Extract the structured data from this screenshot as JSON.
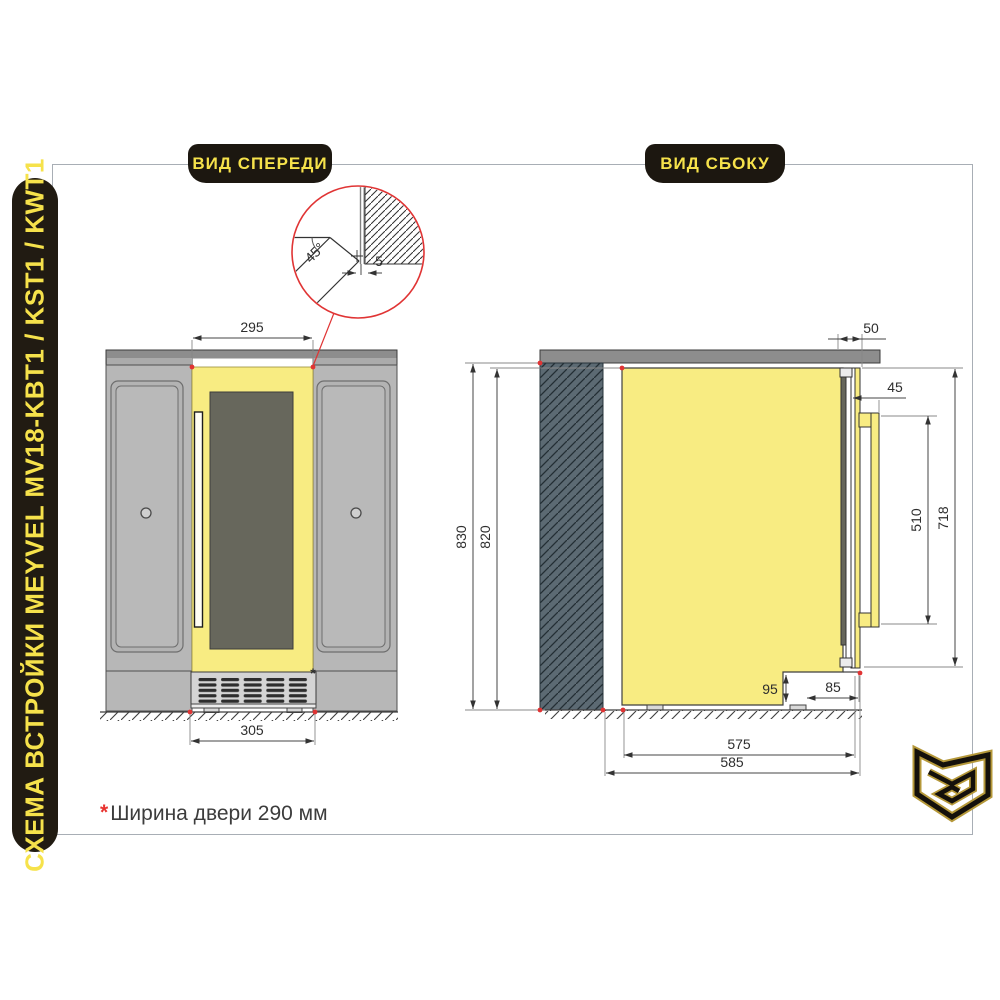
{
  "sidebar": {
    "title": "СХЕМА ВСТРОЙКИ MEYVEL MV18-KBT1 / KST1 / KWT1"
  },
  "badges": {
    "front": "ВИД СПЕРЕДИ",
    "side": "ВИД СБОКУ"
  },
  "front_view": {
    "dim_width_top": "295",
    "dim_width_bottom": "305",
    "detail": {
      "angle": "45°",
      "gap": "5"
    }
  },
  "side_view": {
    "dim_countertop_offset": "50",
    "dim_handle_depth": "45",
    "dim_handle_height": "510",
    "dim_door_height": "718",
    "dim_niche_height": "830",
    "dim_body_height": "820",
    "dim_plinth_height": "95",
    "dim_plinth_inset": "85",
    "dim_depth_body": "575",
    "dim_depth_total": "585"
  },
  "footnote": {
    "marker": "*",
    "text": "Ширина двери 290 мм"
  },
  "colors": {
    "accent_yellow": "#f8ec82",
    "badge_yellow": "#f6e24b",
    "marker_red": "#e03434",
    "wall_fill": "#5c6a73",
    "cabinet_gray": "#b7b7b7",
    "glass_gray": "#67675c",
    "countertop_gray": "#8d8d8d"
  }
}
